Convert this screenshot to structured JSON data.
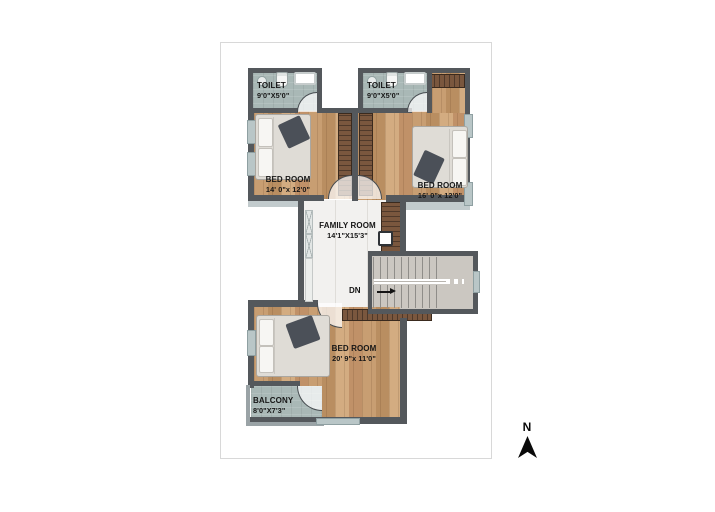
{
  "plan": {
    "title": "upper-floor-plan",
    "rooms": [
      {
        "id": "toilet-left",
        "label": "TOILET",
        "dims": "9'0\"X5'0\""
      },
      {
        "id": "toilet-right",
        "label": "TOILET",
        "dims": "9'0\"X5'0\""
      },
      {
        "id": "bedroom-upper-left",
        "label": "BED ROOM",
        "dims": "14' 0\"x 12'0\""
      },
      {
        "id": "bedroom-upper-right",
        "label": "BED ROOM",
        "dims": "16' 0\"x 12'0\""
      },
      {
        "id": "family-room",
        "label": "FAMILY ROOM",
        "dims": "14'1\"X15'3\""
      },
      {
        "id": "bedroom-lower",
        "label": "BED ROOM",
        "dims": "20' 9\"x 11'0\""
      },
      {
        "id": "balcony",
        "label": "BALCONY",
        "dims": "8'0\"X7'3\""
      }
    ],
    "stairs": {
      "label": "DN"
    },
    "palette": {
      "wall": "#54585c",
      "window": "#b9c6c7",
      "wood": "#c49a6c",
      "tile": "#a9b8b6",
      "marble": "#f2f1ef",
      "stair_floor": "#cbc7c1",
      "wardrobe": "#6a4c36",
      "card_border": "#d8d8d8"
    }
  },
  "compass": {
    "label": "N"
  }
}
